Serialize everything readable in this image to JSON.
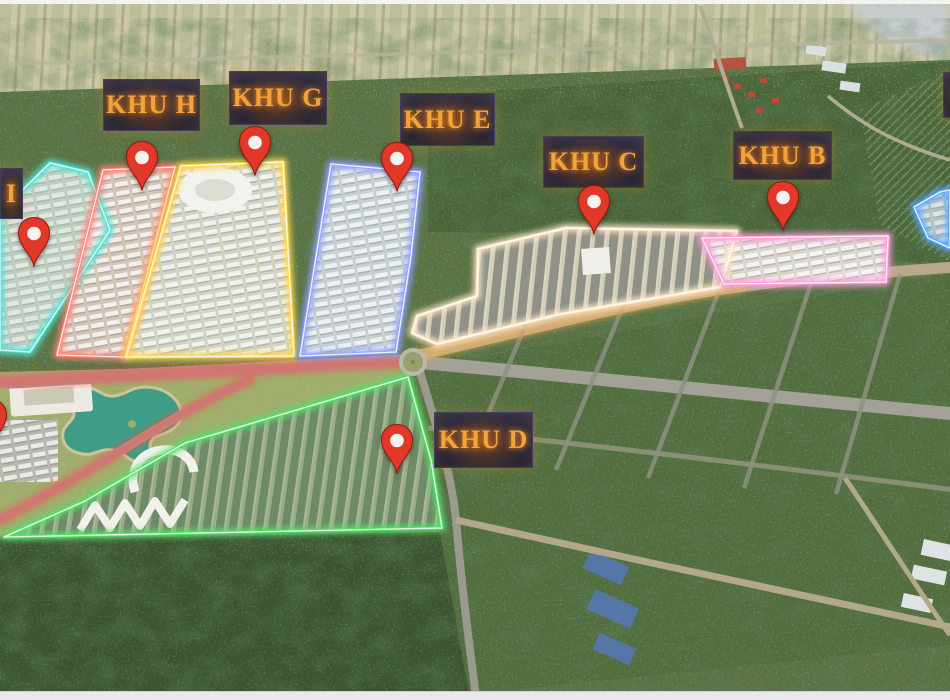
{
  "map": {
    "pin": {
      "fill": "#e2382a",
      "ring": "#f6f3ee",
      "border": "#8e1a10"
    },
    "label_text_color": "#f2a43a",
    "road_glow_colors": {
      "west": "#ff4b46",
      "park": "#ff4b46",
      "east": "#ffb14e",
      "east_far": "#ffb14e"
    },
    "zones": [
      {
        "id": "khu-i",
        "label": "I",
        "color": "#4fe3d4",
        "fill": "rgba(225,236,231,0.75)",
        "pattern": "rowsLight",
        "pattern_opacity": 0.6,
        "polygon": [
          [
            50,
            163
          ],
          [
            88,
            172
          ],
          [
            110,
            230
          ],
          [
            30,
            352
          ],
          [
            0,
            350
          ],
          [
            0,
            212
          ]
        ],
        "label_box": {
          "x": 0,
          "y": 168,
          "w": 23,
          "h": 51
        },
        "pin": {
          "x": 17,
          "y": 216
        }
      },
      {
        "id": "khu-h",
        "label": "KHU H",
        "color": "#ff8478",
        "fill": "rgba(238,216,206,0.82)",
        "pattern": "rowsLight",
        "pattern_opacity": 0.85,
        "polygon": [
          [
            103,
            170
          ],
          [
            175,
            167
          ],
          [
            125,
            357
          ],
          [
            57,
            355
          ]
        ],
        "label_box": {
          "x": 103,
          "y": 79,
          "w": 97,
          "h": 52
        },
        "pin": {
          "x": 125,
          "y": 140
        }
      },
      {
        "id": "khu-g",
        "label": "KHU G",
        "color": "#ffd84f",
        "fill": "rgba(235,233,222,0.82)",
        "pattern": "rowsLight",
        "pattern_opacity": 0.8,
        "polygon": [
          [
            181,
            166
          ],
          [
            283,
            162
          ],
          [
            294,
            356
          ],
          [
            126,
            357
          ]
        ],
        "label_box": {
          "x": 229,
          "y": 71,
          "w": 98,
          "h": 54
        },
        "pin": {
          "x": 238,
          "y": 125
        }
      },
      {
        "id": "khu-e",
        "label": "KHU E",
        "color": "#8fa0ff",
        "fill": "rgba(223,228,240,0.82)",
        "pattern": "rowsLight",
        "pattern_opacity": 0.8,
        "polygon": [
          [
            331,
            164
          ],
          [
            420,
            172
          ],
          [
            411,
            256
          ],
          [
            396,
            352
          ],
          [
            300,
            356
          ]
        ],
        "label_box": {
          "x": 400,
          "y": 93,
          "w": 95,
          "h": 53
        },
        "pin": {
          "x": 380,
          "y": 141
        }
      },
      {
        "id": "khu-c",
        "label": "KHU C",
        "color": "#ffe8c8",
        "fill": "rgba(228,218,198,0.88)",
        "pattern": "rowsDark",
        "pattern_opacity": 0.5,
        "polygon": [
          [
            478,
            249
          ],
          [
            566,
            228
          ],
          [
            737,
            231
          ],
          [
            720,
            287
          ],
          [
            561,
            314
          ],
          [
            437,
            344
          ],
          [
            412,
            333
          ],
          [
            417,
            316
          ],
          [
            477,
            296
          ]
        ],
        "label_box": {
          "x": 543,
          "y": 136,
          "w": 101,
          "h": 52
        },
        "pin": {
          "x": 577,
          "y": 184
        }
      },
      {
        "id": "khu-b",
        "label": "KHU B",
        "color": "#ff9ed9",
        "fill": "rgba(236,228,222,0.88)",
        "pattern": "rowsLight",
        "pattern_opacity": 0.85,
        "polygon": [
          [
            702,
            238
          ],
          [
            888,
            236
          ],
          [
            886,
            282
          ],
          [
            724,
            284
          ]
        ],
        "label_box": {
          "x": 733,
          "y": 131,
          "w": 99,
          "h": 49
        },
        "pin": {
          "x": 766,
          "y": 180
        }
      },
      {
        "id": "khu-d",
        "label": "KHU D",
        "color": "#55e06b",
        "fill": "rgba(206,216,188,0.55)",
        "pattern": "rowsGreen",
        "pattern_opacity": 0.45,
        "polygon": [
          [
            4,
            537
          ],
          [
            85,
            501
          ],
          [
            185,
            443
          ],
          [
            408,
            377
          ],
          [
            431,
            460
          ],
          [
            442,
            528
          ]
        ],
        "label_box": {
          "x": 434,
          "y": 412,
          "w": 99,
          "h": 56
        },
        "pin": {
          "x": 380,
          "y": 423
        }
      },
      {
        "id": "zone-east-partial",
        "label": "",
        "color": "#58a8ff",
        "fill": "rgba(215,226,240,0.72)",
        "pattern": "rowsLight",
        "pattern_opacity": 0.6,
        "polygon": [
          [
            914,
            207
          ],
          [
            940,
            192
          ],
          [
            950,
            190
          ],
          [
            950,
            248
          ],
          [
            928,
            238
          ]
        ],
        "label_box": {
          "x": 943,
          "y": 72,
          "w": 40,
          "h": 46
        },
        "pin": null
      }
    ],
    "extra_pins": [
      {
        "id": "pin-west-partial",
        "x": -26,
        "y": 398
      }
    ]
  }
}
